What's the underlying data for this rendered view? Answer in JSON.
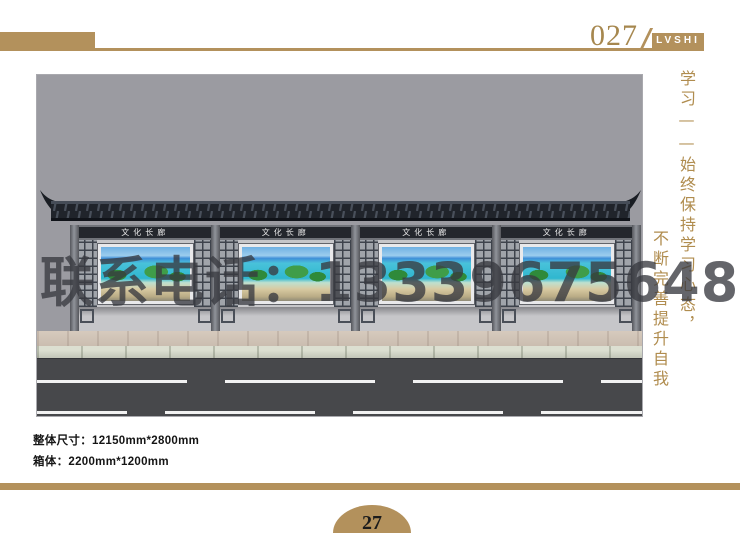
{
  "header": {
    "page_number": "027",
    "brand": "LVSHI"
  },
  "artwork": {
    "bays": [
      {
        "label": "文化长廊"
      },
      {
        "label": "文化长廊"
      },
      {
        "label": "文化长廊"
      },
      {
        "label": "文化长廊"
      }
    ],
    "watermark": "联系电话：13339675648"
  },
  "calligraphy": {
    "line1": "学习——始终保持学习心态，",
    "line2": "不断完善提升自我"
  },
  "specs": {
    "overall_size": "整体尺寸：12150mm*2800mm",
    "box_size": "箱体：2200mm*1200mm"
  },
  "footer": {
    "page_number": "27"
  },
  "colors": {
    "accent_gold": "#b3915c",
    "page_number_gold": "#a6874e",
    "render_background": "#9b9ba1",
    "roof_dark": "#20242b",
    "road_gray": "#47484b",
    "watermark_gray": "#3a3c42",
    "calligraphy_gold": "#b08c4e"
  }
}
